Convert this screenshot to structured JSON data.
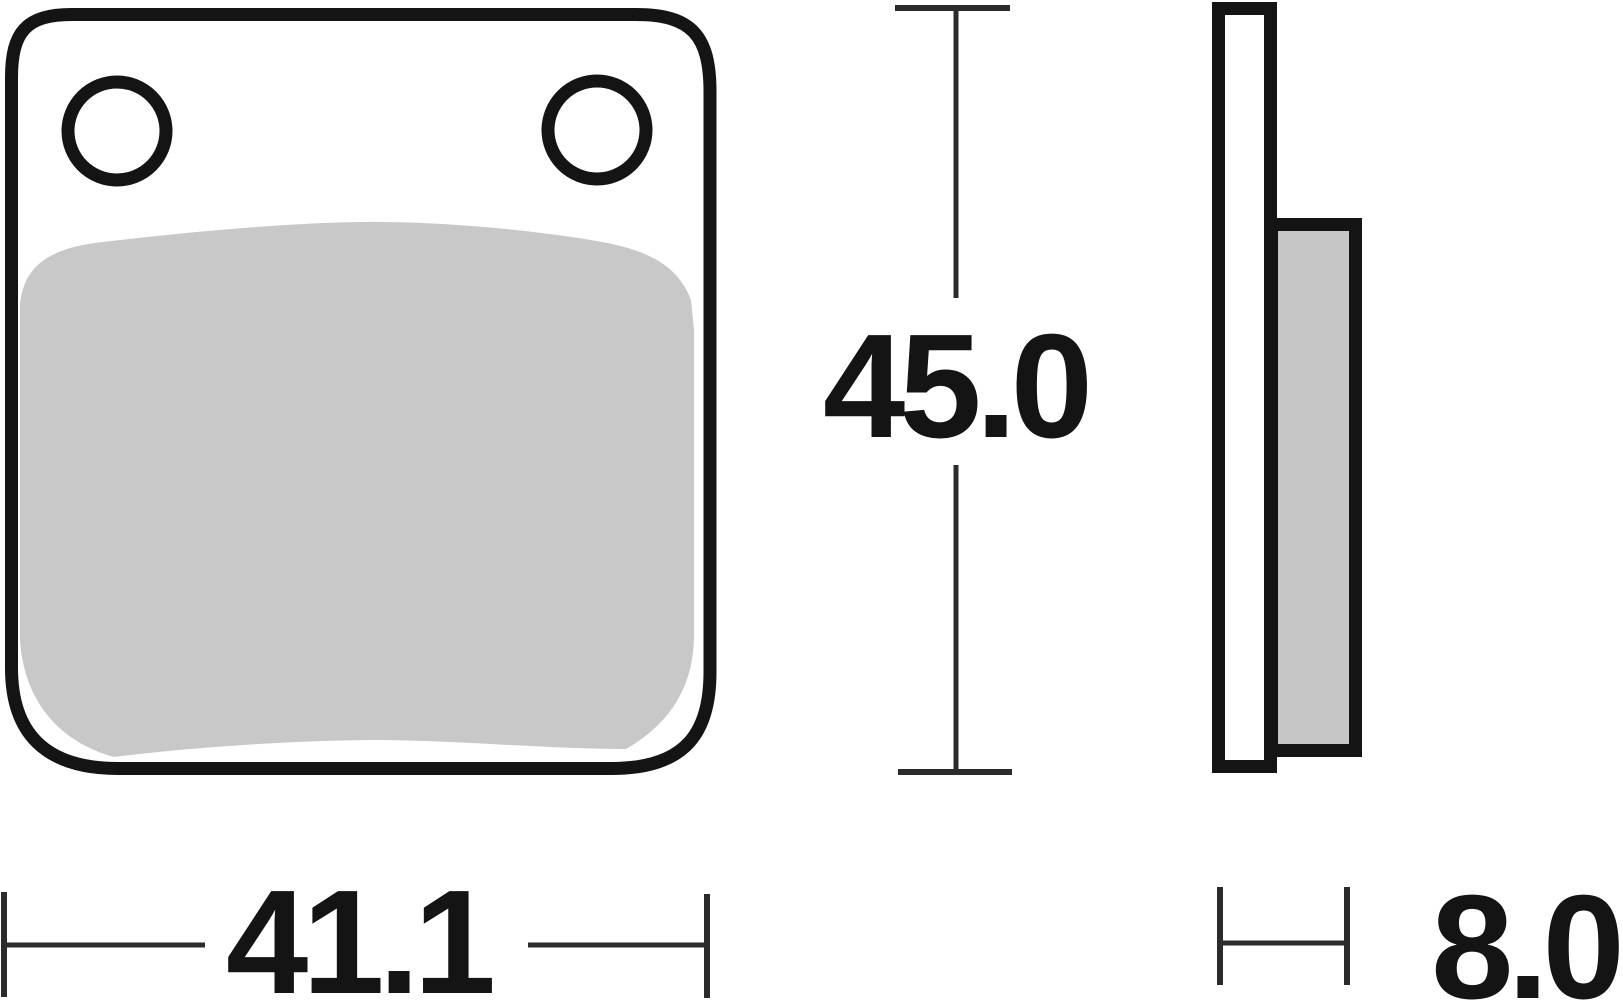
{
  "diagram": {
    "kind": "brake-pad-technical-drawing",
    "dimensions": {
      "width_mm": "41.1",
      "height_mm": "45.0",
      "thickness_mm": "8.0"
    },
    "colors": {
      "outline": "#141414",
      "dimension_line": "#2b2b2b",
      "friction_front": "#c8c8c8",
      "friction_side": "#c6c6c6",
      "plate_fill": "#ffffff",
      "background": "#ffffff"
    }
  }
}
